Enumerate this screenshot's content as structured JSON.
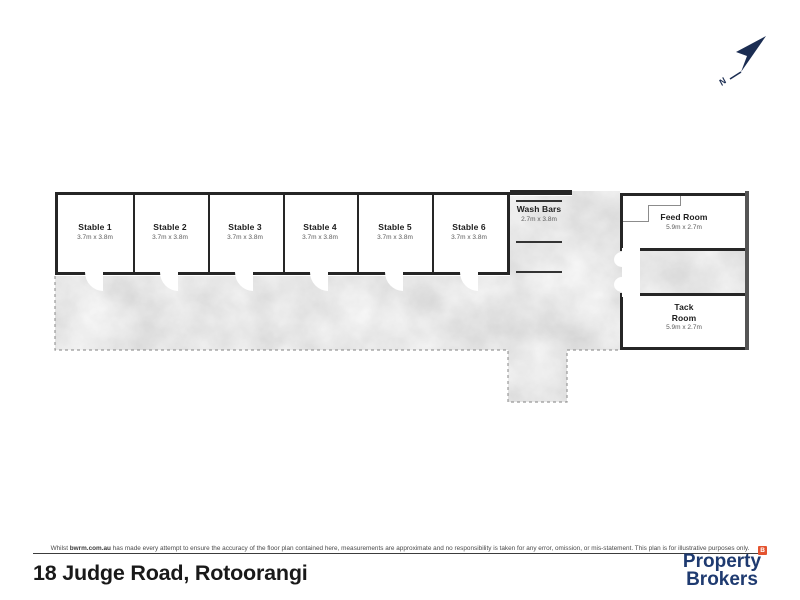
{
  "plan": {
    "north_label": "N",
    "stables": [
      {
        "name": "Stable 1",
        "dims": "3.7m x 3.8m"
      },
      {
        "name": "Stable 2",
        "dims": "3.7m x 3.8m"
      },
      {
        "name": "Stable 3",
        "dims": "3.7m x 3.8m"
      },
      {
        "name": "Stable 4",
        "dims": "3.7m x 3.8m"
      },
      {
        "name": "Stable 5",
        "dims": "3.7m x 3.8m"
      },
      {
        "name": "Stable 6",
        "dims": "3.7m x 3.8m"
      }
    ],
    "wash_bars": {
      "name": "Wash Bars",
      "dims": "2.7m x 3.8m"
    },
    "feed_room": {
      "name": "Feed Room",
      "dims": "5.9m x 2.7m"
    },
    "tack_room": {
      "name": "Tack Room",
      "dims": "5.9m x 2.7m"
    }
  },
  "footer": {
    "disclaimer_prefix": "Whilst ",
    "disclaimer_brand": "bwrm.com.au",
    "disclaimer_rest": " has made every attempt to ensure the accuracy of the floor plan contained here, measurements are approximate and no responsibility is taken for any error, omission, or mis-statement. This plan is for illustrative purposes only.",
    "address": "18 Judge Road, Rotoorangi",
    "logo": {
      "line1": "Property",
      "line2": "Brokers",
      "badge": "B"
    }
  },
  "colors": {
    "wall_black": "#262626",
    "yard_concrete_gray": "#cccccc",
    "dashed_boundary_gray": "#999999",
    "north_arrow_navy": "#1b2d52",
    "logo_navy": "#1e3a70",
    "logo_badge_orange": "#e4532f"
  }
}
